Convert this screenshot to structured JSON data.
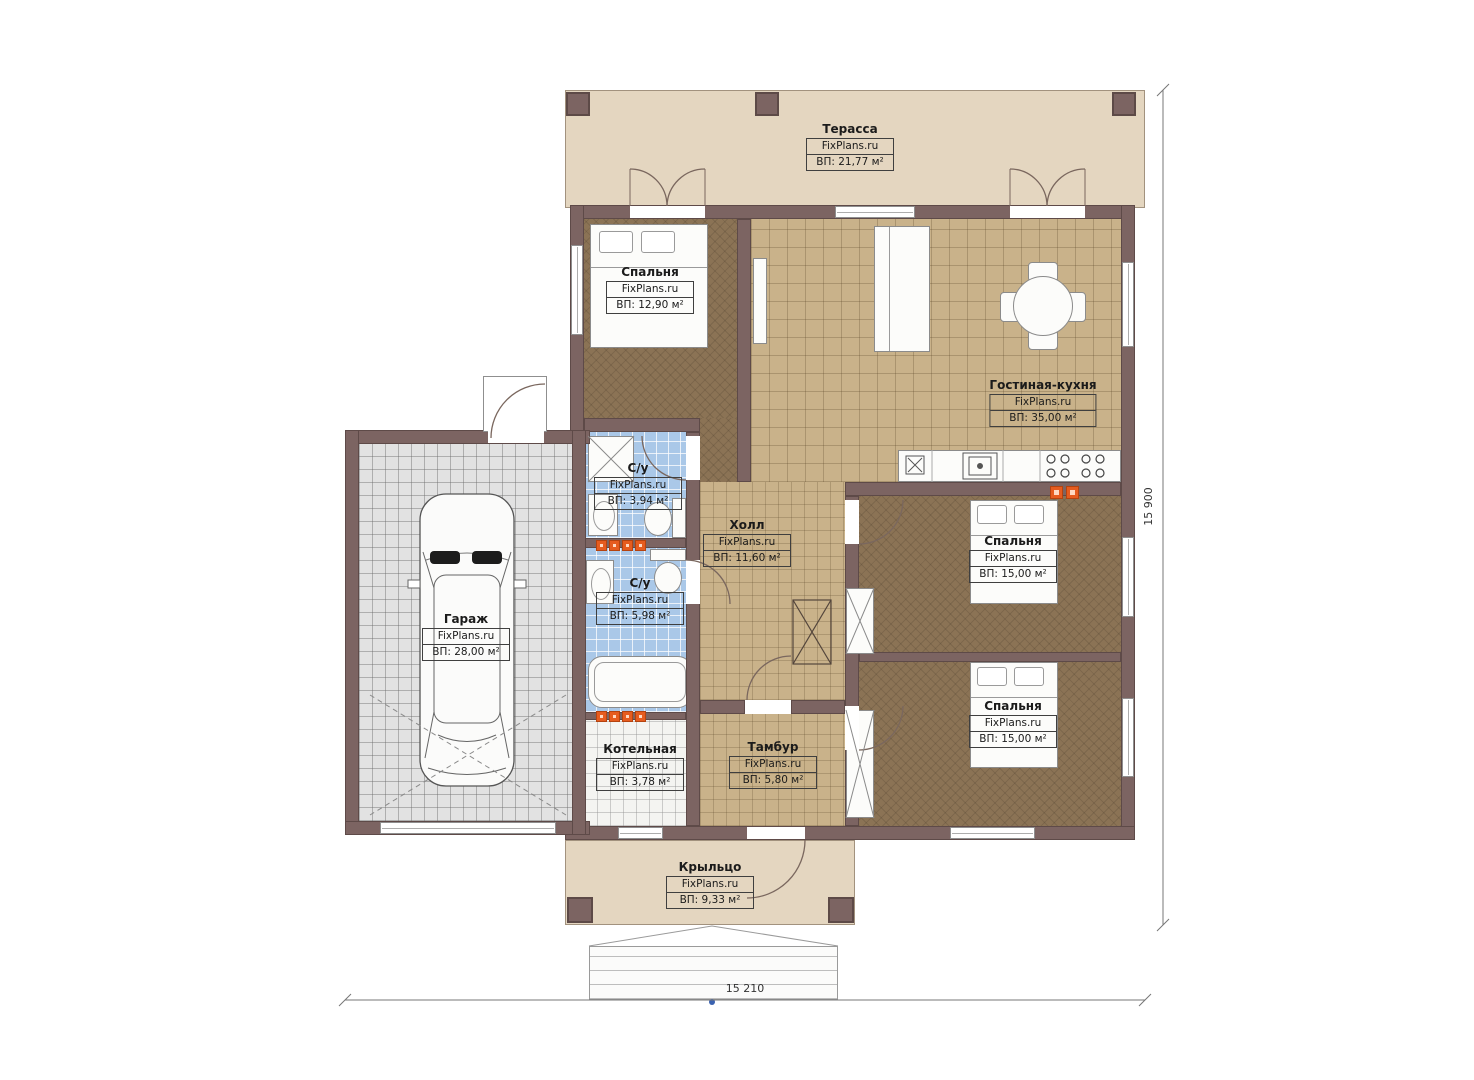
{
  "plan": {
    "site_label": "FixPlans.ru",
    "rooms": {
      "terrace": {
        "name": "Терасса",
        "area": "ВП: 21,77 м²"
      },
      "bedroom1": {
        "name": "Спальня",
        "area": "ВП: 12,90 м²"
      },
      "living": {
        "name": "Гостиная-кухня",
        "area": "ВП: 35,00 м²"
      },
      "bath1": {
        "name": "С/у",
        "area": "ВП: 3,94 м²"
      },
      "hall": {
        "name": "Холл",
        "area": "ВП: 11,60 м²"
      },
      "bedroom2": {
        "name": "Спальня",
        "area": "ВП: 15,00 м²"
      },
      "bath2": {
        "name": "С/у",
        "area": "ВП: 5,98 м²"
      },
      "garage": {
        "name": "Гараж",
        "area": "ВП: 28,00 м²"
      },
      "boiler": {
        "name": "Котельная",
        "area": "ВП: 3,78 м²"
      },
      "vestibule": {
        "name": "Тамбур",
        "area": "ВП: 5,80 м²"
      },
      "bedroom3": {
        "name": "Спальня",
        "area": "ВП: 15,00 м²"
      },
      "porch": {
        "name": "Крыльцо",
        "area": "ВП: 9,33 м²"
      }
    },
    "dimensions": {
      "total_width": "15 210",
      "total_height": "15 900"
    },
    "colors": {
      "wall": "#7c6462",
      "terrace_floor": "#e4d6c0",
      "tile_floor": "#c9b28a",
      "bedroom_floor": "#8b7355",
      "bath_floor": "#aac8e8",
      "garage_floor": "#e2e2e2",
      "radiator_accent": "#e65c1f"
    }
  }
}
